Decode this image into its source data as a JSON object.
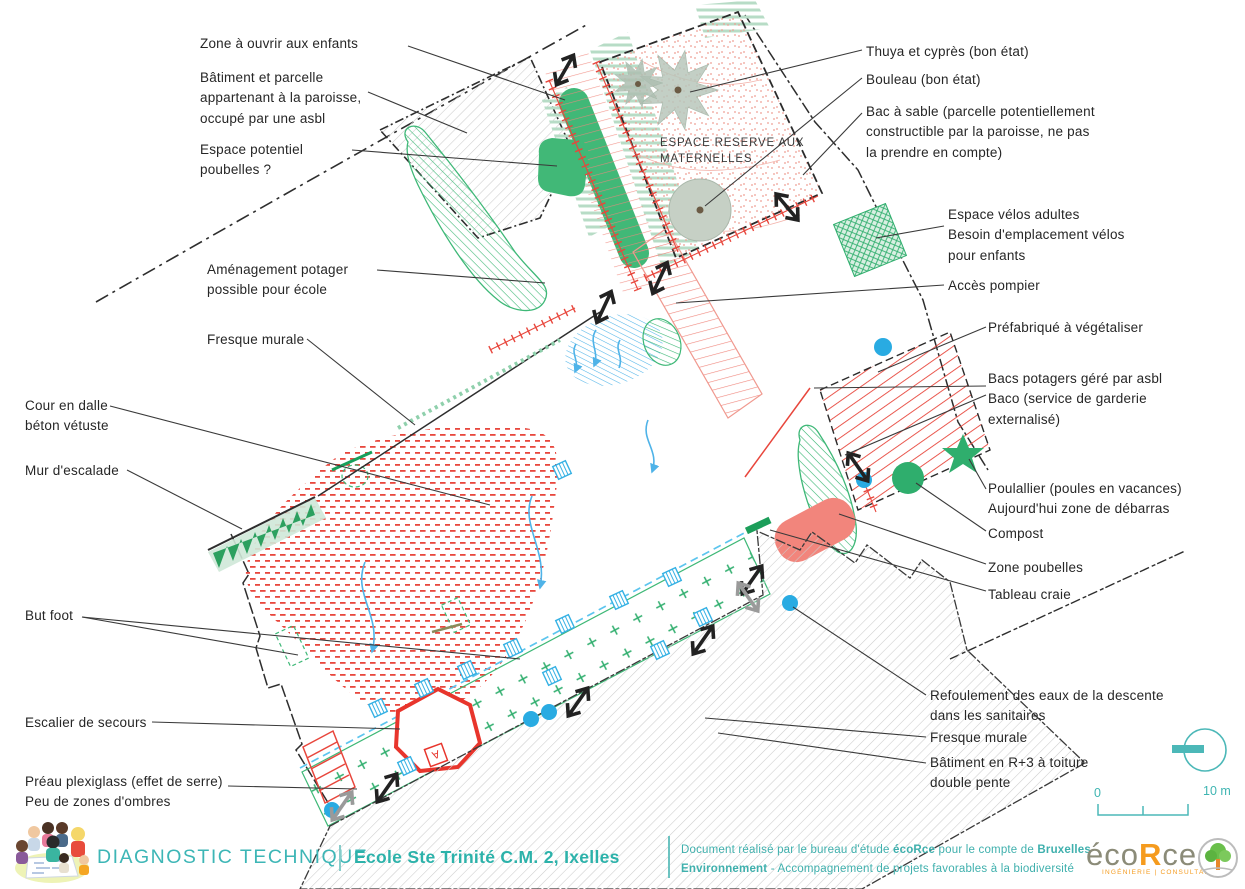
{
  "map": {
    "title_line1": "ESPACE RESERVE AUX",
    "title_line2": "MATERNELLES"
  },
  "scale": {
    "start": "0",
    "end": "10 m"
  },
  "annotations": [
    {
      "id": "zone-ouvrir",
      "text": "Zone à ouvrir aux enfants"
    },
    {
      "id": "batiment-paroisse",
      "text": "Bâtiment et parcelle\nappartenant à la paroisse,\noccupé par une asbl"
    },
    {
      "id": "espace-potentiel-poubelles",
      "text": "Espace potentiel\npoubelles ?"
    },
    {
      "id": "amenagement-potager",
      "text": "Aménagement potager\npossible pour école"
    },
    {
      "id": "fresque-murale-gauche",
      "text": "Fresque murale"
    },
    {
      "id": "cour-dalle",
      "text": "Cour en dalle\nbéton vétuste"
    },
    {
      "id": "mur-escalade",
      "text": "Mur d'escalade"
    },
    {
      "id": "but-foot",
      "text": "But foot"
    },
    {
      "id": "escalier-secours",
      "text": "Escalier de secours"
    },
    {
      "id": "preau",
      "text": "Préau plexiglass (effet de serre)\nPeu de zones d'ombres"
    },
    {
      "id": "thuya",
      "text": "Thuya et cyprès (bon état)"
    },
    {
      "id": "bouleau",
      "text": "Bouleau (bon état)"
    },
    {
      "id": "bac-a-sable",
      "text": "Bac à sable (parcelle potentiellement\nconstructible par la paroisse, ne pas\nla prendre en compte)"
    },
    {
      "id": "espace-velos",
      "text": "Espace vélos adultes\nBesoin d'emplacement vélos\npour enfants"
    },
    {
      "id": "acces-pompier",
      "text": "Accès pompier"
    },
    {
      "id": "prefabrique",
      "text": "Préfabriqué à végétaliser"
    },
    {
      "id": "bacs-potagers",
      "text": "Bacs potagers géré par asbl\nBaco (service de garderie\nexternalisé)"
    },
    {
      "id": "poulallier",
      "text": "Poulallier (poules en vacances)\nAujourd'hui zone de débarras"
    },
    {
      "id": "compost",
      "text": "Compost"
    },
    {
      "id": "zone-poubelles",
      "text": "Zone poubelles"
    },
    {
      "id": "tableau-craie",
      "text": "Tableau craie"
    },
    {
      "id": "refoulement",
      "text": "Refoulement des eaux de la descente\ndans les sanitaires"
    },
    {
      "id": "fresque-murale-droite",
      "text": "Fresque murale"
    },
    {
      "id": "batiment-r3",
      "text": "Bâtiment en R+3 à toiture\ndouble pente"
    }
  ],
  "footer": {
    "brand": "DIAGNOSTIC TECHNIQUE",
    "project": "Ecole Ste Trinité C.M. 2, Ixelles",
    "credit": {
      "s1": "Document réalisé par le bureau d'étude ",
      "s2": "écoRce",
      "s3": " pour le compte de ",
      "s4": "Bruxelles",
      "s5": "Environnement",
      "s6": " - Accompagnement de projets favorables à la biodiversité"
    },
    "ecorce": {
      "p1": "éco",
      "p2": "R",
      "p3": "ce",
      "sub": "INGÉNIERIE | CONSULTANCE"
    }
  },
  "colors": {
    "teal": "#3fb5b2",
    "green": "#3eb877",
    "dark_green": "#2ca05f",
    "light_green": "#b7dcc6",
    "red": "#e8463c",
    "salmon": "#f2857c",
    "pink_hatch": "#f0867c",
    "cyan": "#35b1e4",
    "gray_hatch": "#cccccc",
    "orange": "#f59b1e"
  }
}
